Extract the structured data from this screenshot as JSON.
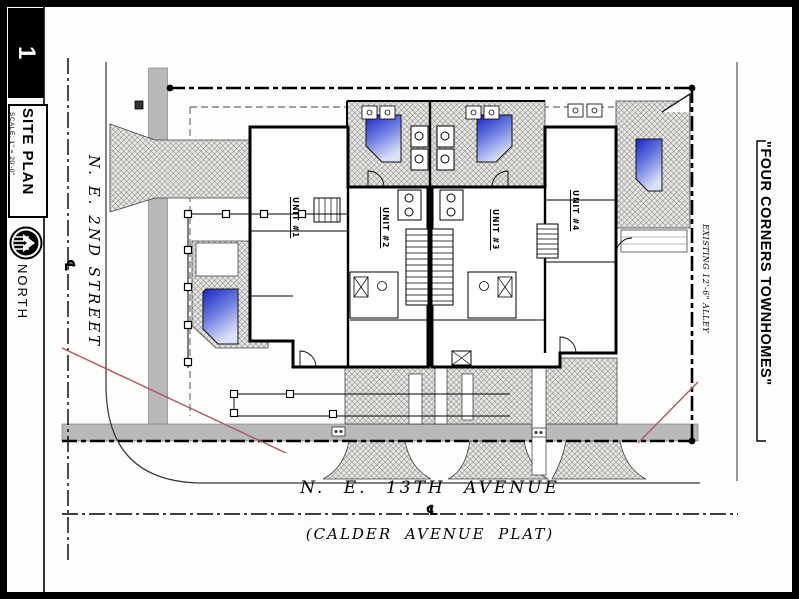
{
  "sheet": {
    "number": "1",
    "title": "SITE PLAN",
    "scale": "SCALE: 1\" = 20'-0\"",
    "north": "NORTH"
  },
  "project": {
    "name": "\"FOUR CORNERS TOWNHOMES\""
  },
  "streets": {
    "west": {
      "name": "N. E. 2ND STREET",
      "centerline": "℄"
    },
    "south": {
      "name": "N. E. 13TH AVENUE",
      "plat": "(CALDER AVENUE PLAT)",
      "centerline": "℄"
    },
    "east": {
      "name": "EXISTING 12'-6\" ALLEY"
    }
  },
  "units": [
    {
      "label": "UNIT #1"
    },
    {
      "label": "UNIT #2"
    },
    {
      "label": "UNIT #3"
    },
    {
      "label": "UNIT #4"
    }
  ],
  "colors": {
    "ink": "#000000",
    "sidewalk_gray": "#b9b9b9",
    "pavement_hatch_bg": "#e7e6e3",
    "pool_dark": "#1b23c4",
    "pool_light": "#d9e0f8",
    "sight_line_red": "#b0546a"
  }
}
